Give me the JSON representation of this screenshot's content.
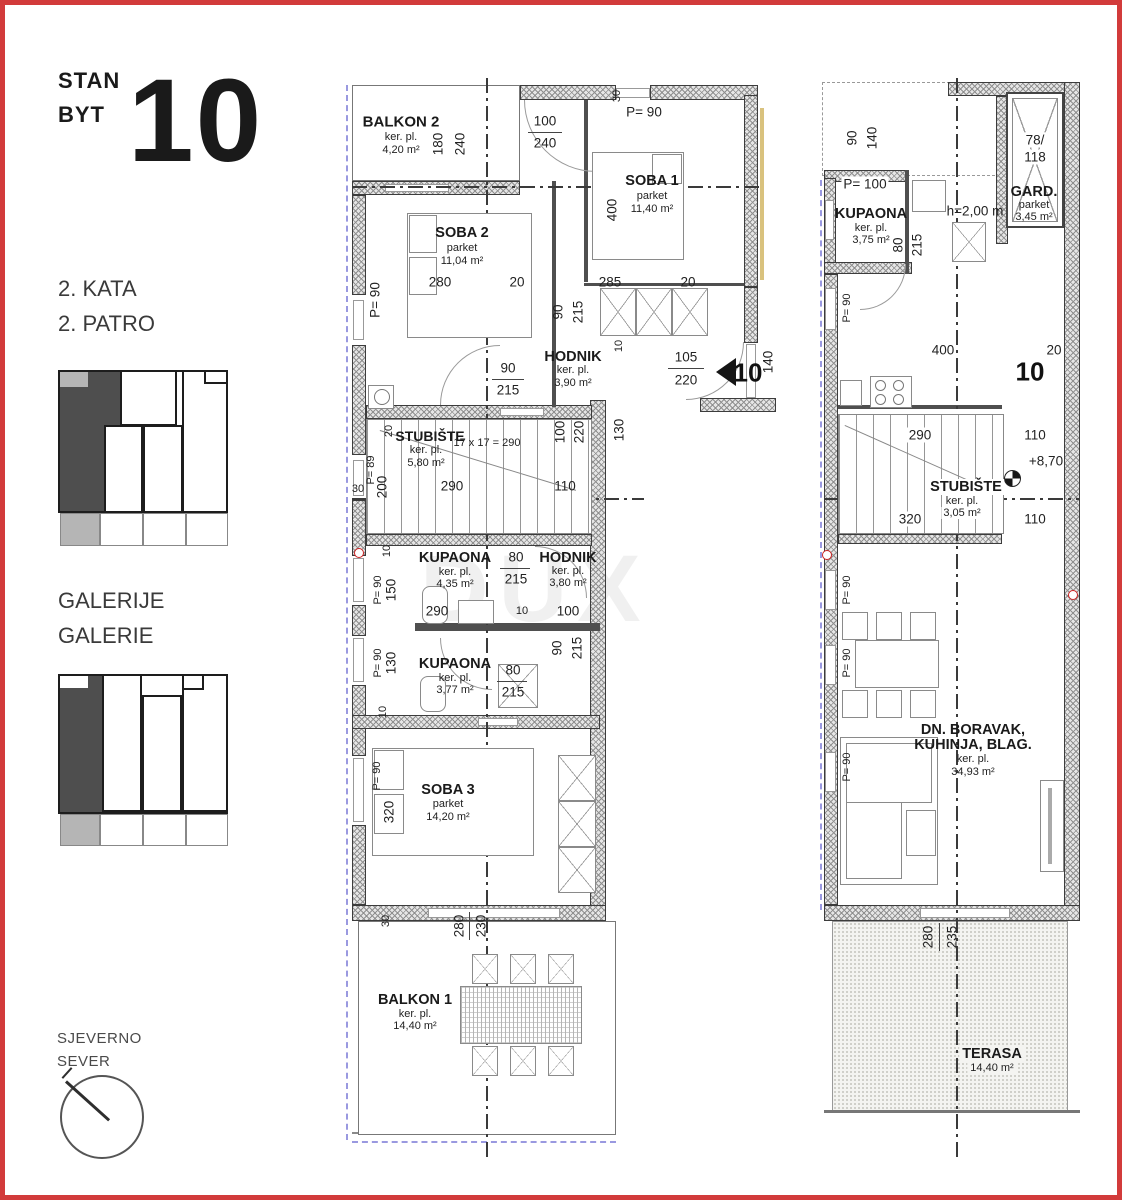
{
  "title": {
    "stan": "STAN",
    "byt": "BYT",
    "number": "10"
  },
  "legend": {
    "floor_hr": "2. KATA",
    "floor_cz": "2. PATRO",
    "gallery_hr": "GALERIJE",
    "gallery_cz": "GALERIE",
    "north_hr": "SJEVERNO",
    "north_cz": "SEVER"
  },
  "watermark": "DUX",
  "colors": {
    "frame": "#d23b3b",
    "wall_hatch": "#8f8f8f",
    "dark_unit": "#4e4e4e",
    "light_unit": "#b5b5b5",
    "blue_dash": "#9a99e0",
    "trim": "#d9c27e",
    "red_marker": "#cc2222"
  },
  "plan_left": {
    "rooms": {
      "balkon2": {
        "name": "BALKON 2",
        "finish": "ker. pl.",
        "area": "4,20 m²"
      },
      "soba1": {
        "name": "SOBA 1",
        "finish": "parket",
        "area": "11,40 m²"
      },
      "soba2": {
        "name": "SOBA 2",
        "finish": "parket",
        "area": "11,04 m²"
      },
      "hodnik1": {
        "name": "HODNIK",
        "finish": "ker. pl.",
        "area": "3,90 m²"
      },
      "stubiste": {
        "name": "STUBIŠTE",
        "finish": "ker. pl.",
        "area": "5,80 m²"
      },
      "kupaona1": {
        "name": "KUPAONA",
        "finish": "ker. pl.",
        "area": "4,35 m²"
      },
      "hodnik2": {
        "name": "HODNIK",
        "finish": "ker. pl.",
        "area": "3,80 m²"
      },
      "kupaona2": {
        "name": "KUPAONA",
        "finish": "ker. pl.",
        "area": "3,77 m²"
      },
      "soba3": {
        "name": "SOBA 3",
        "finish": "parket",
        "area": "14,20 m²"
      },
      "balkon1": {
        "name": "BALKON 1",
        "finish": "ker. pl.",
        "area": "14,40 m²"
      }
    },
    "unit_arrow_number": "10",
    "stair_note": "17 x 17 = 290",
    "dims": {
      "top30": "30",
      "topP90": "P= 90",
      "door100": "100",
      "door240": "240",
      "balk180": "180",
      "balk240": "240",
      "soba1_400": "400",
      "chain280": "280",
      "chain20a": "20",
      "chain285": "285",
      "chain20b": "20",
      "soba2P90": "P= 90",
      "w90a": "90",
      "w215a": "215",
      "w10a": "10",
      "w130": "130",
      "d90": "90",
      "d215": "215",
      "ent105": "105",
      "ent220": "220",
      "ent140": "140",
      "hall100": "100",
      "hall220": "220",
      "st20": "20",
      "st290": "290",
      "st110": "110",
      "stP89": "P= 89",
      "st200": "200",
      "st30": "30",
      "k10": "10",
      "kP90a": "P= 90",
      "k150": "150",
      "k290": "290",
      "k10b": "10",
      "k100": "100",
      "k80a": "80",
      "k215a": "215",
      "kd90": "90",
      "kd215": "215",
      "k80b": "80",
      "k215b": "215",
      "kP90b": "P= 90",
      "k130": "130",
      "k10c": "10",
      "s3P90": "P= 90",
      "s3_320": "320",
      "bot30": "30",
      "bot280": "280",
      "bot230": "230"
    }
  },
  "plan_right": {
    "rooms": {
      "kupaona": {
        "name": "KUPAONA",
        "finish": "ker. pl.",
        "area": "3,75 m²"
      },
      "gard": {
        "name": "GARD.",
        "finish": "parket",
        "area": "3,45 m²"
      },
      "stubiste": {
        "name": "STUBIŠTE",
        "finish": "ker. pl.",
        "area": "3,05 m²"
      },
      "living": {
        "name1": "DN. BORAVAK,",
        "name2": "KUHINJA, BLAG.",
        "finish": "ker. pl.",
        "area": "34,93 m²"
      },
      "terasa": {
        "name": "TERASA",
        "area": "14,40 m²"
      }
    },
    "unit_number": "10",
    "level": "+8,70",
    "height_note": "h=2,00 m",
    "skylight1": "78/",
    "skylight2": "118",
    "dims": {
      "v90": "90",
      "v140": "140",
      "p100": "P= 100",
      "k80": "80",
      "k215": "215",
      "kP90": "P= 90",
      "w400": "400",
      "w20": "20",
      "s290": "290",
      "s110a": "110",
      "s320": "320",
      "s110b": "110",
      "p90a": "P= 90",
      "p90b": "P= 90",
      "p90c": "P= 90",
      "b280": "280",
      "b235": "235"
    }
  }
}
